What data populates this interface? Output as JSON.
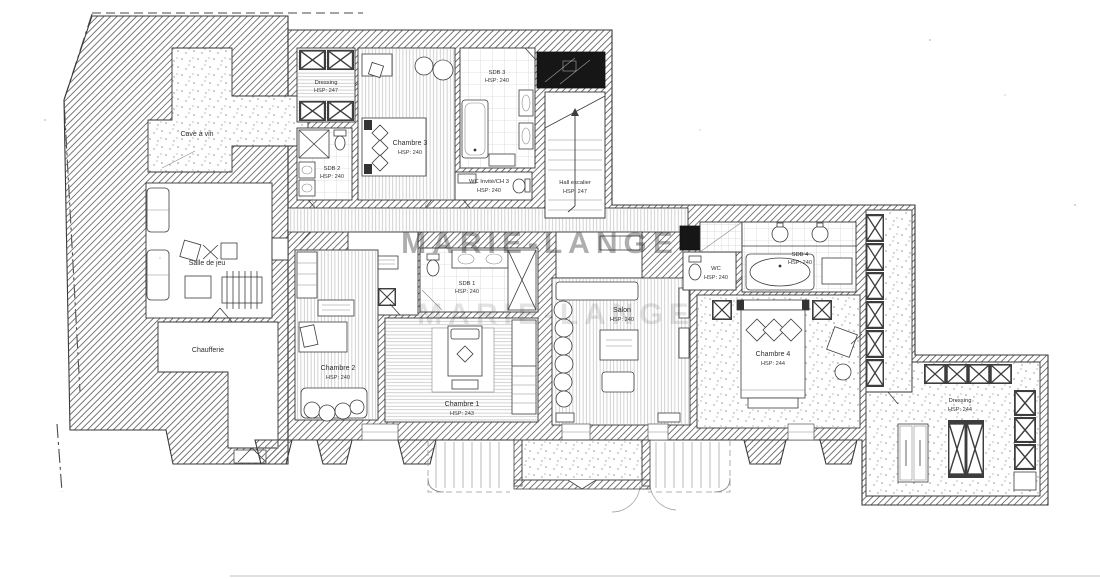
{
  "watermark": {
    "text": "MARIE-LANGE"
  },
  "colors": {
    "paper": "#ffffff",
    "ink": "#2e2e2e",
    "hatch_line": "#6e6e6e",
    "floor_line": "#bdbdbd",
    "stipple_dot": "#8f8f8f",
    "shaft_black": "#161616",
    "watermark_gray": "#9c9c9c"
  },
  "rooms": [
    {
      "id": "cave-a-vin",
      "name": "Cave à vin",
      "hsp": ""
    },
    {
      "id": "salle-de-jeu",
      "name": "Salle de jeu",
      "hsp": ""
    },
    {
      "id": "chaufferie",
      "name": "Chaufferie",
      "hsp": ""
    },
    {
      "id": "dressing-nord",
      "name": "Dressing",
      "hsp": "HSP: 247"
    },
    {
      "id": "sdb-2",
      "name": "SDB 2",
      "hsp": "HSP: 240"
    },
    {
      "id": "chambre-3",
      "name": "Chambre 3",
      "hsp": "HSP: 240"
    },
    {
      "id": "sdb-3",
      "name": "SDB 3",
      "hsp": "HSP: 240"
    },
    {
      "id": "wc-invite-ch3",
      "name": "WC Invité/CH 3",
      "hsp": "HSP: 240"
    },
    {
      "id": "hall-escalier",
      "name": "Hall escalier",
      "hsp": "HSP: 247"
    },
    {
      "id": "chambre-2",
      "name": "Chambre 2",
      "hsp": "HSP: 240"
    },
    {
      "id": "sdb-1",
      "name": "SDB 1",
      "hsp": "HSP: 240"
    },
    {
      "id": "chambre-1",
      "name": "Chambre 1",
      "hsp": "HSP: 243"
    },
    {
      "id": "salon",
      "name": "Salon",
      "hsp": "HSP: 240"
    },
    {
      "id": "wc",
      "name": "WC",
      "hsp": "HSP: 240"
    },
    {
      "id": "sdb-4",
      "name": "SDB 4",
      "hsp": "HSP: 240"
    },
    {
      "id": "chambre-4",
      "name": "Chambre 4",
      "hsp": "HSP: 244"
    },
    {
      "id": "dressing-sud",
      "name": "Dressing",
      "hsp": "HSP: 244"
    }
  ]
}
